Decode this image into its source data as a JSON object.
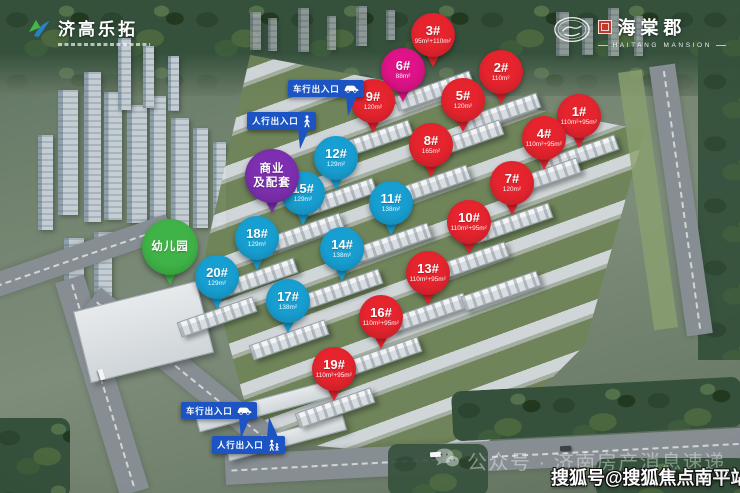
{
  "logos": {
    "developer": {
      "name": "济高乐拓"
    },
    "project": {
      "name": "海棠郡",
      "sub": "HAITANG MANSION"
    }
  },
  "colors": {
    "red": "#e5242e",
    "magenta": "#dd1387",
    "blue": "#189fd2",
    "purple": "#7c2fae",
    "green": "#3fb347",
    "entrance": "#1c54c4"
  },
  "pins": [
    {
      "label": "3#",
      "sub": "95m²+110m²",
      "color": "red",
      "cx": 433,
      "cy": 35
    },
    {
      "label": "6#",
      "sub": "88m²",
      "color": "magenta",
      "cx": 403,
      "cy": 70
    },
    {
      "label": "2#",
      "sub": "110m²",
      "color": "red",
      "cx": 501,
      "cy": 72
    },
    {
      "label": "9#",
      "sub": "120m²",
      "color": "red",
      "cx": 373,
      "cy": 101
    },
    {
      "label": "5#",
      "sub": "120m²",
      "color": "red",
      "cx": 463,
      "cy": 100
    },
    {
      "label": "1#",
      "sub": "110m²+95m²",
      "color": "red",
      "cx": 579,
      "cy": 116
    },
    {
      "label": "4#",
      "sub": "110m²+95m²",
      "color": "red",
      "cx": 544,
      "cy": 138
    },
    {
      "label": "8#",
      "sub": "165m²",
      "color": "red",
      "cx": 431,
      "cy": 145
    },
    {
      "label": "12#",
      "sub": "129m²",
      "color": "blue",
      "cx": 336,
      "cy": 158
    },
    {
      "label": "7#",
      "sub": "120m²",
      "color": "red",
      "cx": 512,
      "cy": 183
    },
    {
      "label": "15#",
      "sub": "129m²",
      "color": "blue",
      "cx": 303,
      "cy": 193
    },
    {
      "label": "11#",
      "sub": "138m²",
      "color": "blue",
      "cx": 391,
      "cy": 203
    },
    {
      "label": "10#",
      "sub": "110m²+95m²",
      "color": "red",
      "cx": 469,
      "cy": 222
    },
    {
      "label": "18#",
      "sub": "129m²",
      "color": "blue",
      "cx": 257,
      "cy": 238
    },
    {
      "label": "14#",
      "sub": "138m²",
      "color": "blue",
      "cx": 342,
      "cy": 249
    },
    {
      "label": "20#",
      "sub": "129m²",
      "color": "blue",
      "cx": 217,
      "cy": 277
    },
    {
      "label": "13#",
      "sub": "110m²+95m²",
      "color": "red",
      "cx": 428,
      "cy": 273
    },
    {
      "label": "17#",
      "sub": "138m²",
      "color": "blue",
      "cx": 288,
      "cy": 301
    },
    {
      "label": "16#",
      "sub": "110m²+95m²",
      "color": "red",
      "cx": 381,
      "cy": 317
    },
    {
      "label": "19#",
      "sub": "110m²+95m²",
      "color": "red",
      "cx": 334,
      "cy": 369
    }
  ],
  "facility_pins": [
    {
      "name": "commercial-pin",
      "lines": [
        "商业",
        "及配套"
      ],
      "color": "purple",
      "cx": 272,
      "cy": 176,
      "d": 54
    },
    {
      "name": "kindergarten-pin",
      "lines": [
        "幼儿园"
      ],
      "color": "green",
      "cx": 170,
      "cy": 247,
      "d": 56
    }
  ],
  "entrances": [
    {
      "name": "vehicle-entrance-top",
      "label": "车行出入口",
      "icon": "car-icon",
      "x": 288,
      "y": 80,
      "tail": "down"
    },
    {
      "name": "pedestrian-entrance-top",
      "label": "人行出入口",
      "icon": "pedestrian-icon",
      "x": 247,
      "y": 112,
      "tail": "down"
    },
    {
      "name": "vehicle-entrance-bottom",
      "label": "车行出入口",
      "icon": "car-icon",
      "x": 181,
      "y": 402,
      "tail": "down"
    },
    {
      "name": "pedestrian-entrance-bottom",
      "label": "人行出入口",
      "icon": "pedestrian-family-icon",
      "x": 212,
      "y": 436,
      "tail": "up"
    }
  ],
  "watermarks": {
    "wechat_text": "公众号 · 济南房产消息速递",
    "sohu_text": "搜狐号@搜狐焦点南平站"
  }
}
